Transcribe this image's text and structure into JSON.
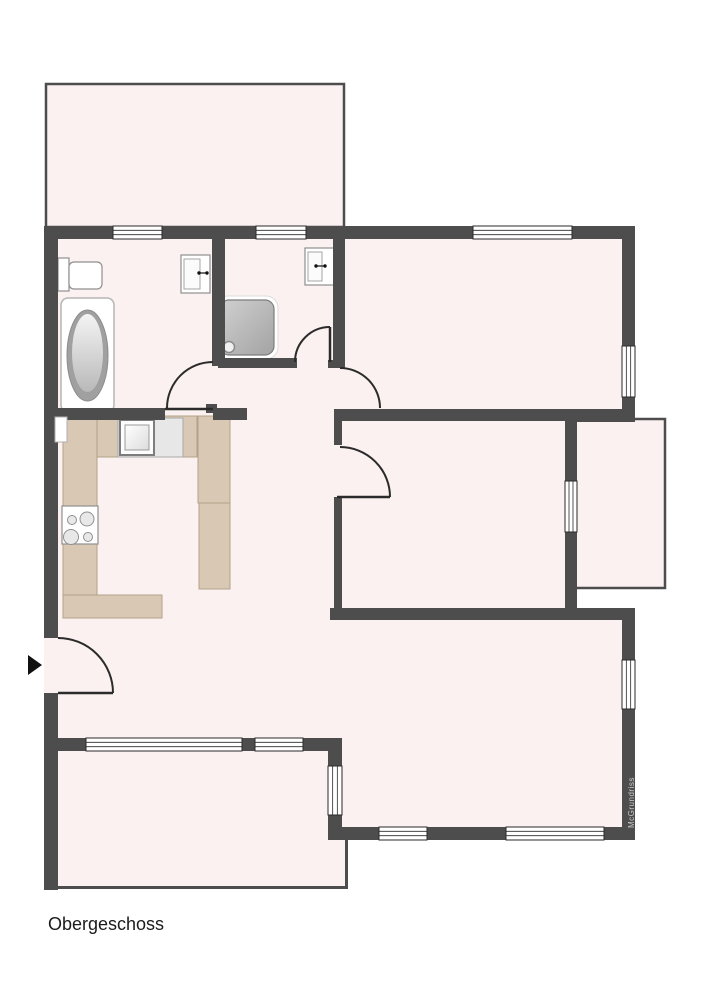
{
  "title": {
    "label": "Obergeschoss"
  },
  "watermark": {
    "label": "McGrundriss"
  },
  "colors": {
    "wall": "#4d4d4d",
    "room_fill": "#fcf1f1",
    "counter": "#d9c8b3",
    "counter_border": "#b3a288",
    "fixture_border": "#8f8f8f",
    "door_stroke": "#2b2b2b",
    "window_border": "#2a2a2a",
    "text": "#1b1b1b",
    "watermark_text": "#c9c9c9",
    "background": "#ffffff"
  },
  "floor_plan": {
    "floor_label": "Obergeschoss",
    "fixtures": [
      "balcony-top",
      "balcony-right",
      "bathtub",
      "toilet",
      "bathroom-sink",
      "shower",
      "shower-room-sink",
      "kitchen-counter",
      "kitchen-sink",
      "stove-hob",
      "entrance-arrow"
    ],
    "door_count": 5,
    "window_count": 11,
    "windows": [
      {
        "x": 113,
        "y": 226,
        "w": 49,
        "h": 13,
        "o": "h"
      },
      {
        "x": 256,
        "y": 226,
        "w": 50,
        "h": 13,
        "o": "h"
      },
      {
        "x": 473,
        "y": 226,
        "w": 99,
        "h": 13,
        "o": "h"
      },
      {
        "x": 622,
        "y": 346,
        "w": 13,
        "h": 51,
        "o": "v"
      },
      {
        "x": 565,
        "y": 481,
        "w": 12,
        "h": 51,
        "o": "v"
      },
      {
        "x": 622,
        "y": 660,
        "w": 13,
        "h": 49,
        "o": "v"
      },
      {
        "x": 86,
        "y": 738,
        "w": 156,
        "h": 13,
        "o": "h"
      },
      {
        "x": 255,
        "y": 738,
        "w": 48,
        "h": 13,
        "o": "h"
      },
      {
        "x": 328,
        "y": 766,
        "w": 14,
        "h": 49,
        "o": "v"
      },
      {
        "x": 379,
        "y": 827,
        "w": 48,
        "h": 13,
        "o": "h"
      },
      {
        "x": 506,
        "y": 827,
        "w": 98,
        "h": 13,
        "o": "h"
      }
    ]
  }
}
